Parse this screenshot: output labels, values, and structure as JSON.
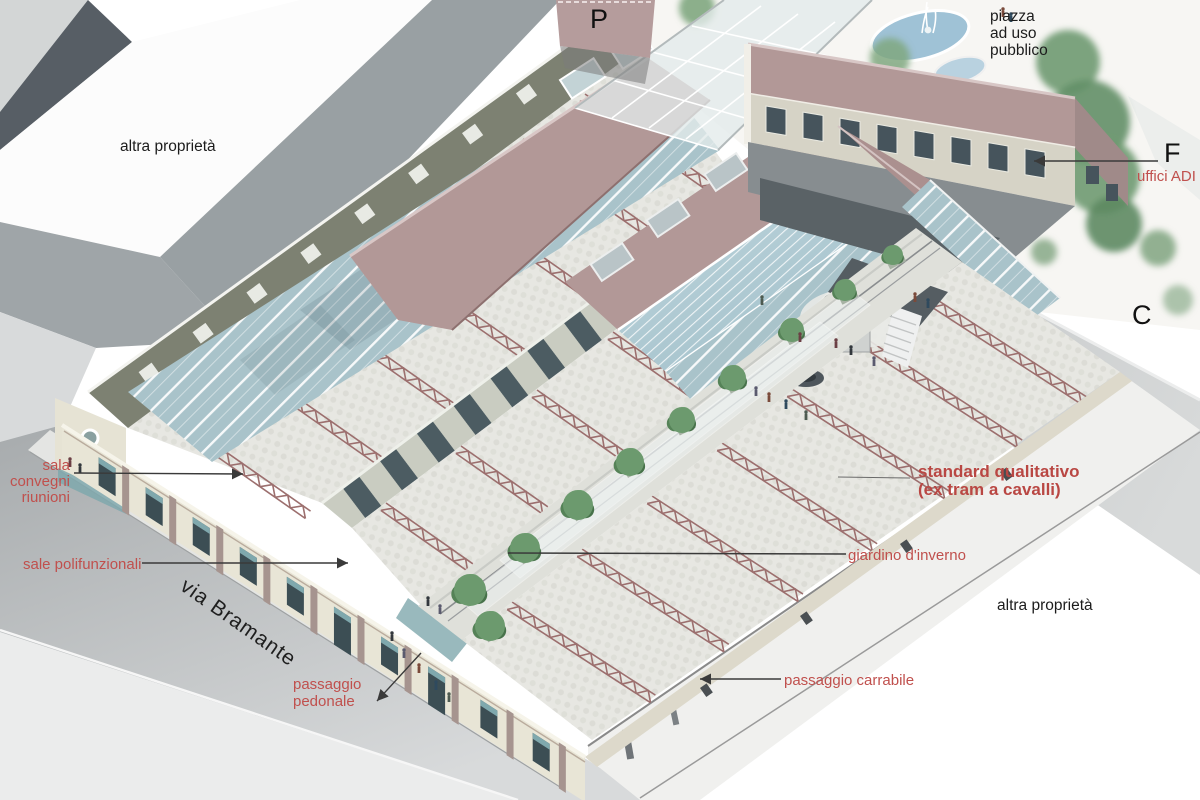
{
  "scene_type": "architectural axonometric rendering with annotations",
  "palette": {
    "label_red": "#c0504d",
    "label_red_bold": "#b94743",
    "label_black": "#1c1c1c",
    "roof_mauve": "#b29897",
    "glass_blue": "#a9c3ca",
    "truss_red": "#9c6f6e",
    "wall_olive": "#7d8172",
    "facade_cream": "#e8e5d6",
    "street_gray": "#b5b8b9",
    "floor_pale": "#e7e7e2",
    "tree_green": "#6c9a6e"
  },
  "labels": {
    "altra_proprieta_top": {
      "text": "altra proprietà"
    },
    "parcheggio_marker": {
      "text": "P"
    },
    "piazza": {
      "line1": "piazza",
      "line2": "ad uso",
      "line3": "pubblico"
    },
    "f_marker": {
      "text": "F"
    },
    "uffici_adi": {
      "text": "uffici ADI"
    },
    "c_marker": {
      "text": "C"
    },
    "sala_convegni": {
      "line1": "sala",
      "line2": "convegni",
      "line3": "riunioni"
    },
    "sale_polifunzionali": {
      "text": "sale polifunzionali"
    },
    "via_bramante": {
      "text": "via Bramante"
    },
    "passaggio_pedonale": {
      "line1": "passaggio",
      "line2": "pedonale"
    },
    "standard_qualitativo": {
      "line1": "standard qualitativo",
      "line2": "(ex tram a cavalli)"
    },
    "giardino_inverno": {
      "text": "giardino d'inverno"
    },
    "altra_proprieta_bottom": {
      "text": "altra proprietà"
    },
    "passaggio_carrabile": {
      "text": "passaggio carrabile"
    }
  }
}
